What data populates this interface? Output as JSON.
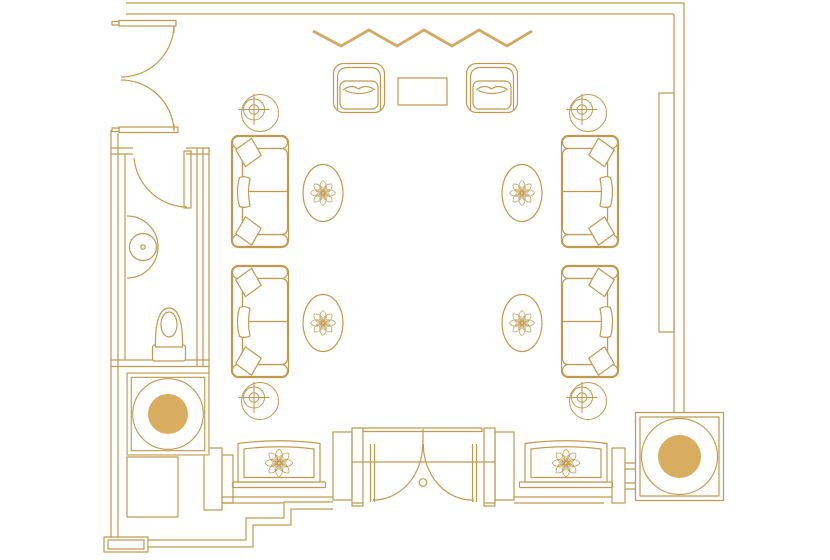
{
  "app": "floor-plan",
  "colors": {
    "line": "#BF9A4F",
    "gold": "#D8AD5F",
    "zigzag": "#D2AA64",
    "background": "#FFFFFF"
  },
  "plan": {
    "rooms": [
      {
        "name": "main-lounge"
      },
      {
        "name": "powder-room"
      },
      {
        "name": "entry-vestibule"
      }
    ],
    "items": [
      {
        "def": "zigzag",
        "name": "drapery-zigzag",
        "x": 0,
        "y": 0
      },
      {
        "def": "armchair",
        "name": "armchair-top-left",
        "x": 333,
        "y": 63
      },
      {
        "def": "armchair",
        "name": "armchair-top-right",
        "x": 466,
        "y": 63
      },
      {
        "def": "rect-table",
        "name": "cocktail-table",
        "x": 398,
        "y": 78
      },
      {
        "def": "sofa",
        "name": "sofa-upper-left",
        "x": 231,
        "y": 135
      },
      {
        "def": "sofa",
        "name": "sofa-lower-left",
        "x": 231,
        "y": 265
      },
      {
        "def": "sofa",
        "name": "sofa-upper-right",
        "x": 619,
        "y": 135,
        "sx": -1
      },
      {
        "def": "sofa",
        "name": "sofa-lower-right",
        "x": 619,
        "y": 265,
        "sx": -1
      },
      {
        "def": "oval-table",
        "name": "oval-side-table-upper-left",
        "x": 323,
        "y": 193
      },
      {
        "def": "oval-table",
        "name": "oval-side-table-lower-left",
        "x": 323,
        "y": 323
      },
      {
        "def": "oval-table",
        "name": "oval-side-table-upper-right",
        "x": 522,
        "y": 193
      },
      {
        "def": "oval-table",
        "name": "oval-side-table-lower-right",
        "x": 522,
        "y": 323
      },
      {
        "def": "speaker",
        "name": "ceiling-speaker-upper-left",
        "x": 260,
        "y": 113
      },
      {
        "def": "speaker",
        "name": "ceiling-speaker-lower-left",
        "x": 260,
        "y": 401
      },
      {
        "def": "speaker",
        "name": "ceiling-speaker-upper-right",
        "x": 588,
        "y": 113
      },
      {
        "def": "speaker",
        "name": "ceiling-speaker-lower-right",
        "x": 588,
        "y": 401
      },
      {
        "def": "round-table",
        "name": "round-side-table-left",
        "x": 168,
        "y": 414,
        "s": 0.93
      },
      {
        "def": "round-table",
        "name": "round-side-table-right",
        "x": 679.5,
        "y": 456.5
      },
      {
        "def": "bench",
        "name": "window-bench-left",
        "x": 279,
        "y": 463
      },
      {
        "def": "bench",
        "name": "window-bench-right",
        "x": 566,
        "y": 463
      },
      {
        "def": "toilet",
        "name": "toilet",
        "x": 169,
        "y": 326
      },
      {
        "def": "sink",
        "name": "sink-basin",
        "x": 143,
        "y": 247
      }
    ]
  }
}
